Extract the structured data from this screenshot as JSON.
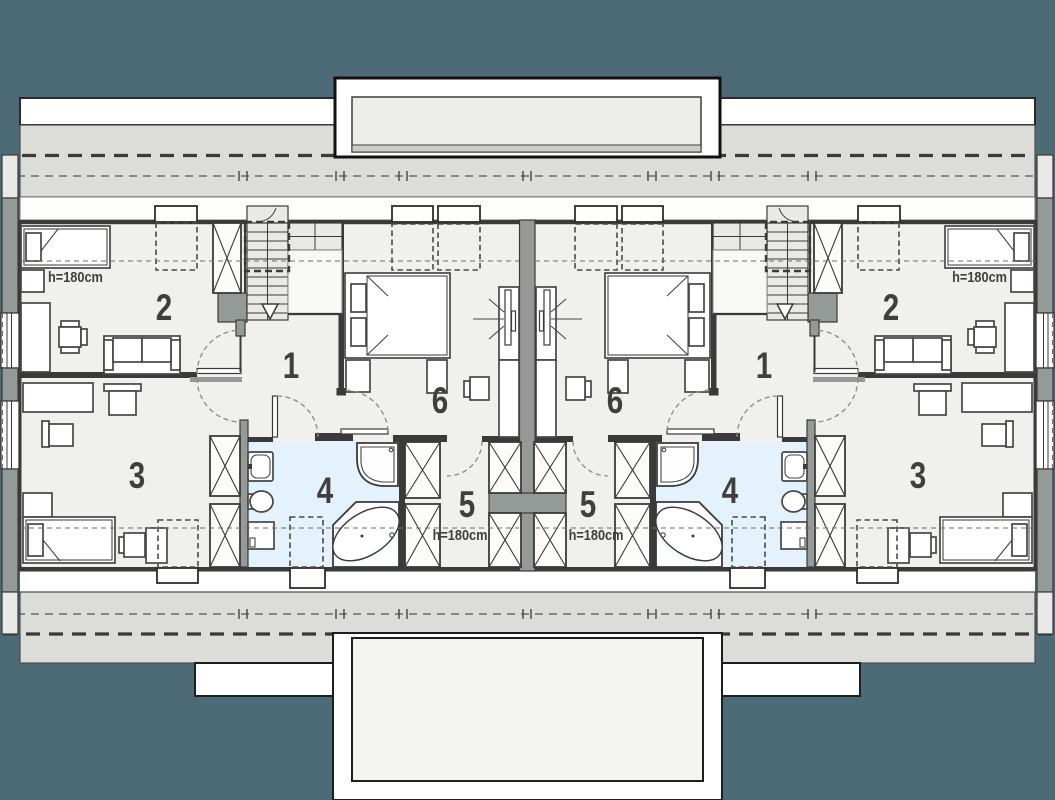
{
  "plan": {
    "units": {
      "left": {
        "room_numbers": {
          "n1": "1",
          "n2": "2",
          "n3": "3",
          "n4": "4",
          "n5": "5",
          "n6": "6"
        },
        "height_notes": {
          "top": "h=180cm",
          "bottom": "h=180cm"
        }
      },
      "right": {
        "room_numbers": {
          "n1": "1",
          "n2": "2",
          "n3": "3",
          "n4": "4",
          "n5": "5",
          "n6": "6"
        },
        "height_notes": {
          "top": "h=180cm",
          "bottom": "h=180cm"
        }
      }
    },
    "colors": {
      "background": "#4d6b76",
      "floor": "#f0f0ee",
      "roof_band": "#dcdcd8",
      "wall_dark": "#3a3a3a",
      "wall_gray": "#949a98",
      "bathroom": "#e3f2fc",
      "terrace": "#ffffff"
    }
  }
}
